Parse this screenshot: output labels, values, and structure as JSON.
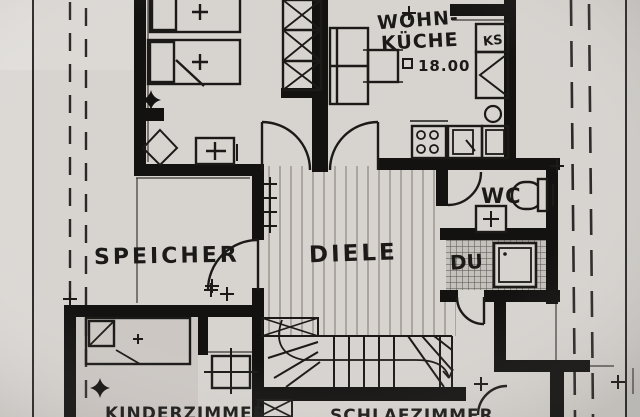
{
  "plan": {
    "rooms": {
      "wohnkueche": {
        "label_line1": "WOHN-",
        "label_line2": "KÜCHE",
        "area_value": "18.00"
      },
      "speicher": {
        "label": "SPEICHER"
      },
      "diele": {
        "label": "DIELE"
      },
      "wc": {
        "label": "WC"
      },
      "dusche": {
        "label": "DU"
      },
      "kinderzimmer": {
        "label": "KINDERZIMMER"
      },
      "schlafzimmer": {
        "label": "SCHLAFZIMMER"
      }
    },
    "fixtures": {
      "fridge_label": "KS"
    },
    "colors": {
      "paper": "#d7d3cf",
      "ink": "#1c1a18",
      "wall": "#141210",
      "pencil_hatch": "#8d8880"
    }
  }
}
